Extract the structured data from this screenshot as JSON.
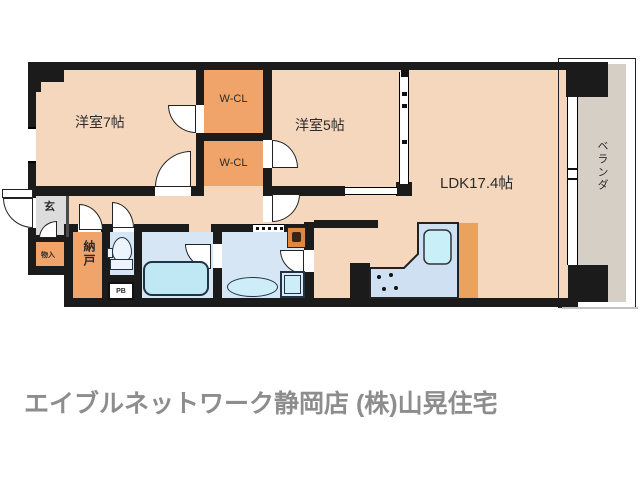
{
  "floorplan": {
    "rooms": {
      "bedroom7": "洋室7帖",
      "wcl_top": "W-CL",
      "wcl_bottom": "W-CL",
      "bedroom5": "洋室5帖",
      "ldk": "LDK17.4帖",
      "veranda": "ベランダ",
      "entrance": "玄",
      "nando": "納戸",
      "monoire": "物入",
      "pb": "PB"
    },
    "colors": {
      "room_floor": "#f4d7bc",
      "closet_orange": "#f0a469",
      "entrance_gray": "#dcdcdc",
      "veranda_gray": "#d6cfc5",
      "wet_area_blue": "#d7e6f5",
      "bathtub_blue": "#bfe8f4",
      "wall_black": "#1b1b1b"
    }
  },
  "footer": {
    "brand": "エイブルネットワーク静岡店 (株)山晃住宅"
  }
}
